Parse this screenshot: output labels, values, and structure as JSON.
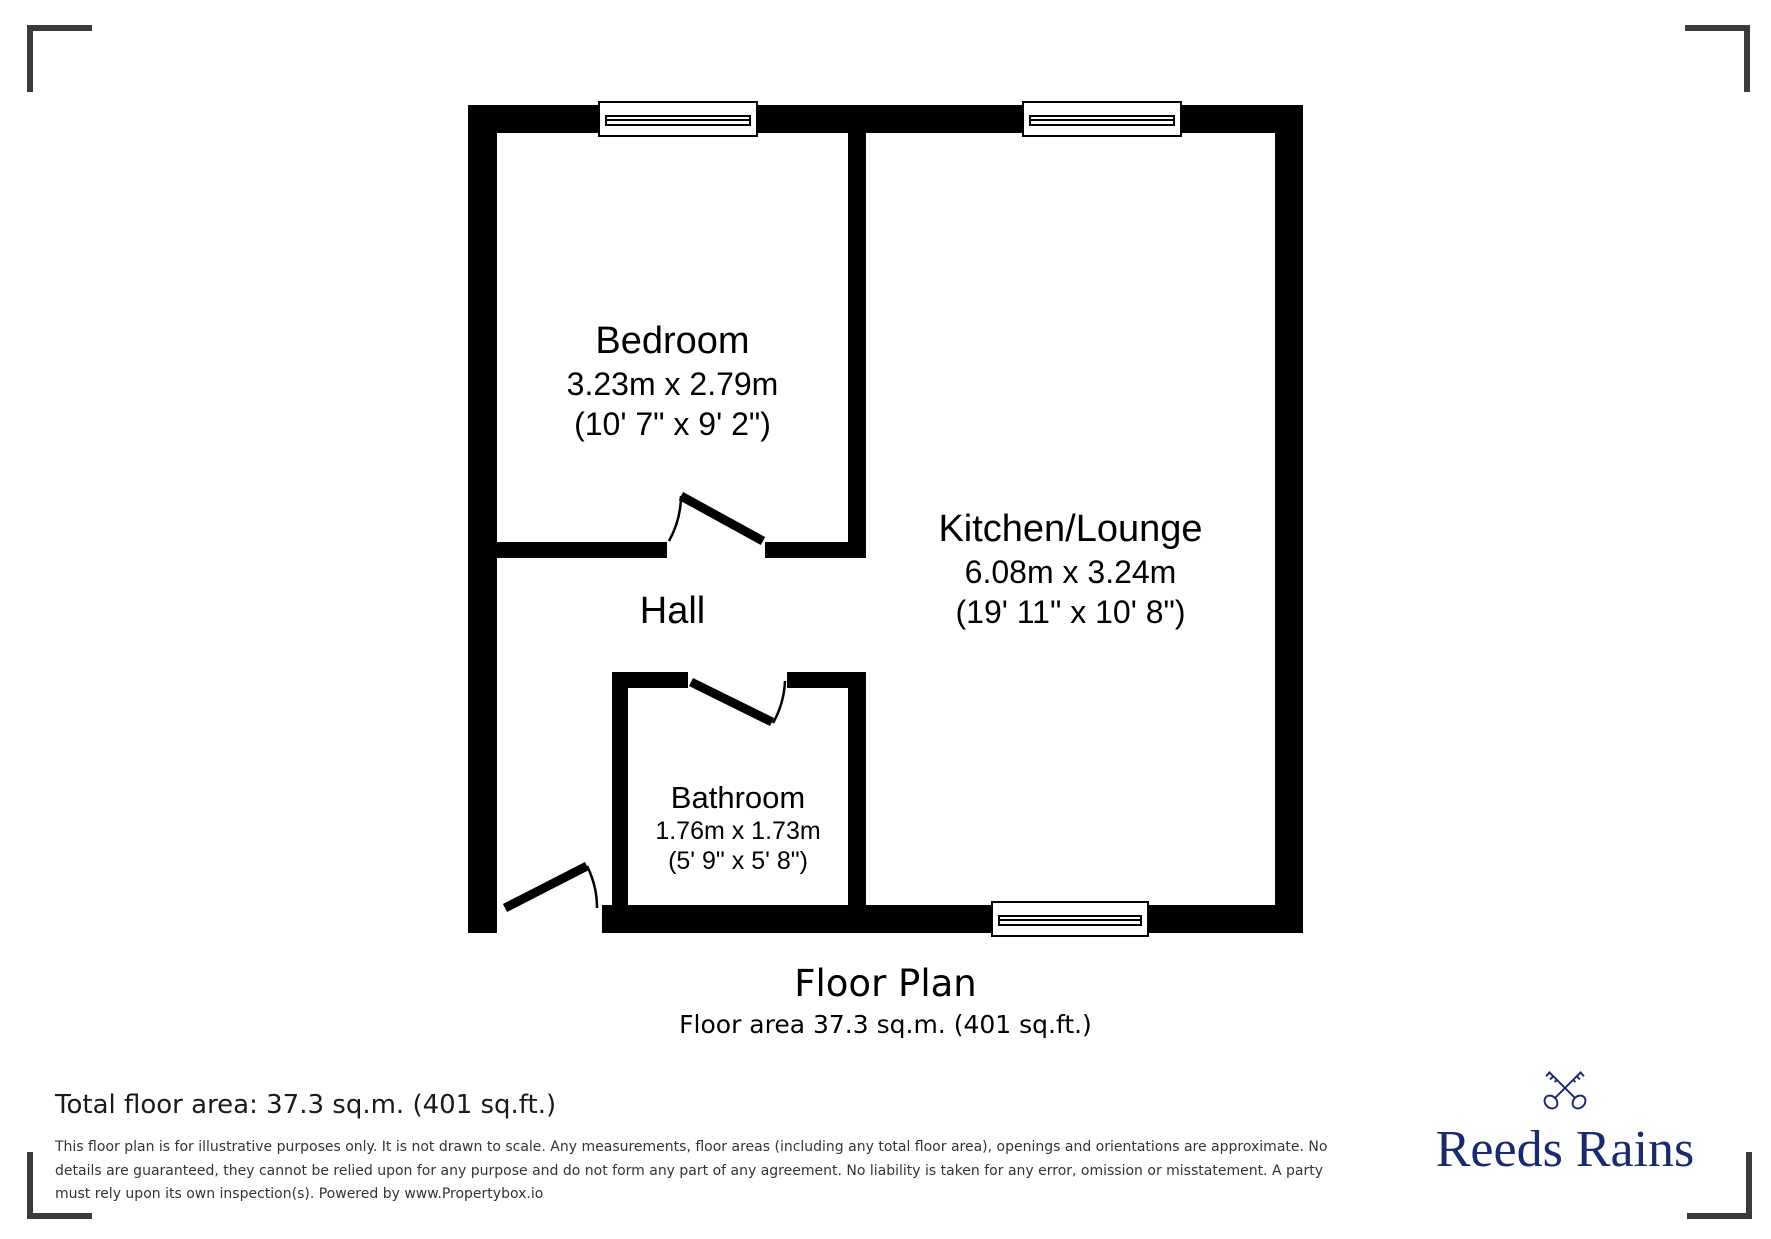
{
  "plan": {
    "title": "Floor Plan",
    "area_line": "Floor area 37.3 sq.m. (401 sq.ft.)",
    "rooms": {
      "bedroom": {
        "name": "Bedroom",
        "metric": "3.23m x 2.79m",
        "imperial": "(10' 7\" x 9' 2\")"
      },
      "kitchen": {
        "name": "Kitchen/Lounge",
        "metric": "6.08m x 3.24m",
        "imperial": "(19' 11\" x 10' 8\")"
      },
      "hall": {
        "name": "Hall"
      },
      "bathroom": {
        "name": "Bathroom",
        "metric": "1.76m x 1.73m",
        "imperial": "(5' 9\" x 5' 8\")"
      }
    }
  },
  "footer": {
    "total_area": "Total floor area: 37.3 sq.m. (401 sq.ft.)",
    "disclaimer_lines": [
      "This floor plan is for illustrative purposes only. It is not drawn to scale. Any measurements, floor areas (including any total floor area), openings and orientations are approximate. No",
      "details are guaranteed, they cannot be relied upon for any purpose and do not form any part of any agreement. No liability is taken for any error, omission or misstatement. A party",
      "must rely upon its own inspection(s). Powered by www.Propertybox.io"
    ]
  },
  "branding": {
    "name": "Reeds Rains",
    "icon": "crossed-keys",
    "color": "#1a2a6e"
  },
  "colors": {
    "wall": "#000000",
    "crop_mark": "#3a3a3a",
    "caption_text": "#1a1a1a",
    "disclaimer_text": "#333333"
  }
}
